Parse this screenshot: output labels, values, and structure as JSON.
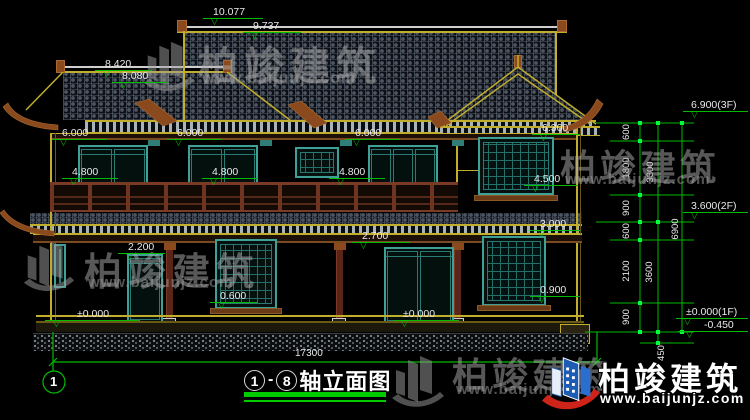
{
  "watermark": {
    "brand": "柏竣建筑",
    "site": "www.baijunjz.com"
  },
  "title_block": {
    "from": "1",
    "to": "8",
    "dash": "-",
    "name": "轴立面图"
  },
  "axis": {
    "bubble": "1"
  },
  "markers": [
    {
      "v": "10.077"
    },
    {
      "v": "9.737"
    },
    {
      "v": "8.420"
    },
    {
      "v": "8.080"
    },
    {
      "v": "6.000"
    },
    {
      "v": "6.000"
    },
    {
      "v": "6.000"
    },
    {
      "v": "4.800"
    },
    {
      "v": "4.800"
    },
    {
      "v": "4.800"
    },
    {
      "v": "6.300"
    },
    {
      "v": "4.500"
    },
    {
      "v": "3.000"
    },
    {
      "v": "0.900"
    },
    {
      "v": "2.700"
    },
    {
      "v": "2.200"
    },
    {
      "v": "0.600"
    },
    {
      "v": "±0.000"
    },
    {
      "v": "±0.000"
    },
    {
      "v": "6.900(3F)"
    },
    {
      "v": "3.600(2F)"
    },
    {
      "v": "±0.000(1F)"
    },
    {
      "v": "-0.450"
    }
  ],
  "dims": {
    "chain": [
      "600",
      "1800",
      "900",
      "600",
      "2100",
      "900"
    ],
    "totals": [
      "3300",
      "3600",
      "6900"
    ],
    "below_grade": "450",
    "overall_width": "17300"
  }
}
